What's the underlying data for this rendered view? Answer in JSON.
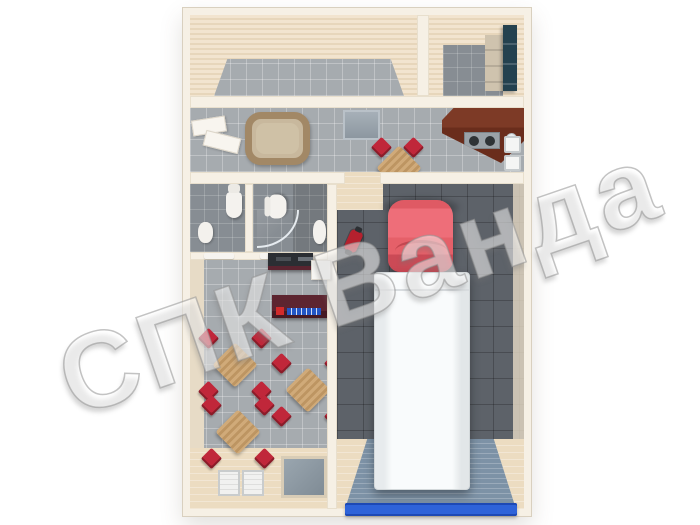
{
  "watermark": {
    "text": "СПК Ванда"
  },
  "palette": {
    "wall_outer": "#f6f0e5",
    "wall_face": "#efe3d0",
    "tile_gray": "#a6abaf",
    "tile_dark": "#878d93",
    "garage_gray": "#5d6269",
    "wood": "#ecdcc1",
    "chair_red": "#c0273a",
    "table_tan": "#c9a774",
    "tub_rim": "#a28866",
    "locker_teal": "#24414f",
    "counter_brown": "#6a2d1c",
    "counter_maroon": "#5d2530",
    "car_red": "#ea6a74",
    "truck_white": "#f9fbfc",
    "door_blue": "#2e63d9",
    "ramp_blue": "#7d92a6"
  },
  "scene": {
    "type": "top-down 3D floor plan render of a modular building with garage",
    "rooms": [
      {
        "name": "storage-room",
        "floor": "gray tile"
      },
      {
        "name": "locker-room",
        "floor": "gray tile",
        "items": [
          "teal-locker-cabinet",
          "beige-lockers"
        ]
      },
      {
        "name": "kitchen-corridor",
        "floor": "gray tile",
        "items": [
          "open-door",
          "bathtub",
          "doormat",
          "small-table-with-2-red-chairs",
          "kitchen-counter-with-sink-and-burners",
          "wall-windows"
        ]
      },
      {
        "name": "wc-1",
        "floor": "gray tile",
        "items": [
          "toilet",
          "sink"
        ]
      },
      {
        "name": "wc-2-shower",
        "floor": "gray tile",
        "items": [
          "toilet",
          "corner-shower-glass",
          "sink"
        ]
      },
      {
        "name": "cafe-dining-room",
        "floor": "gray tile + wood",
        "items": [
          "reception-desk",
          "white-counter",
          "display-counter-with-logo",
          "dining-table-set-1",
          "dining-table-set-2",
          "dining-table-set-3",
          "white-doormat-pair",
          "recessed-gray-mat"
        ]
      },
      {
        "name": "garage-bay",
        "floor": "dark gray tile + blue ramp",
        "items": [
          "red-motorcycle",
          "red-car",
          "white-box-truck",
          "ramp",
          "blue-roller-door-threshold"
        ]
      }
    ],
    "dining_table_count": 3,
    "chairs_per_table": 4
  }
}
